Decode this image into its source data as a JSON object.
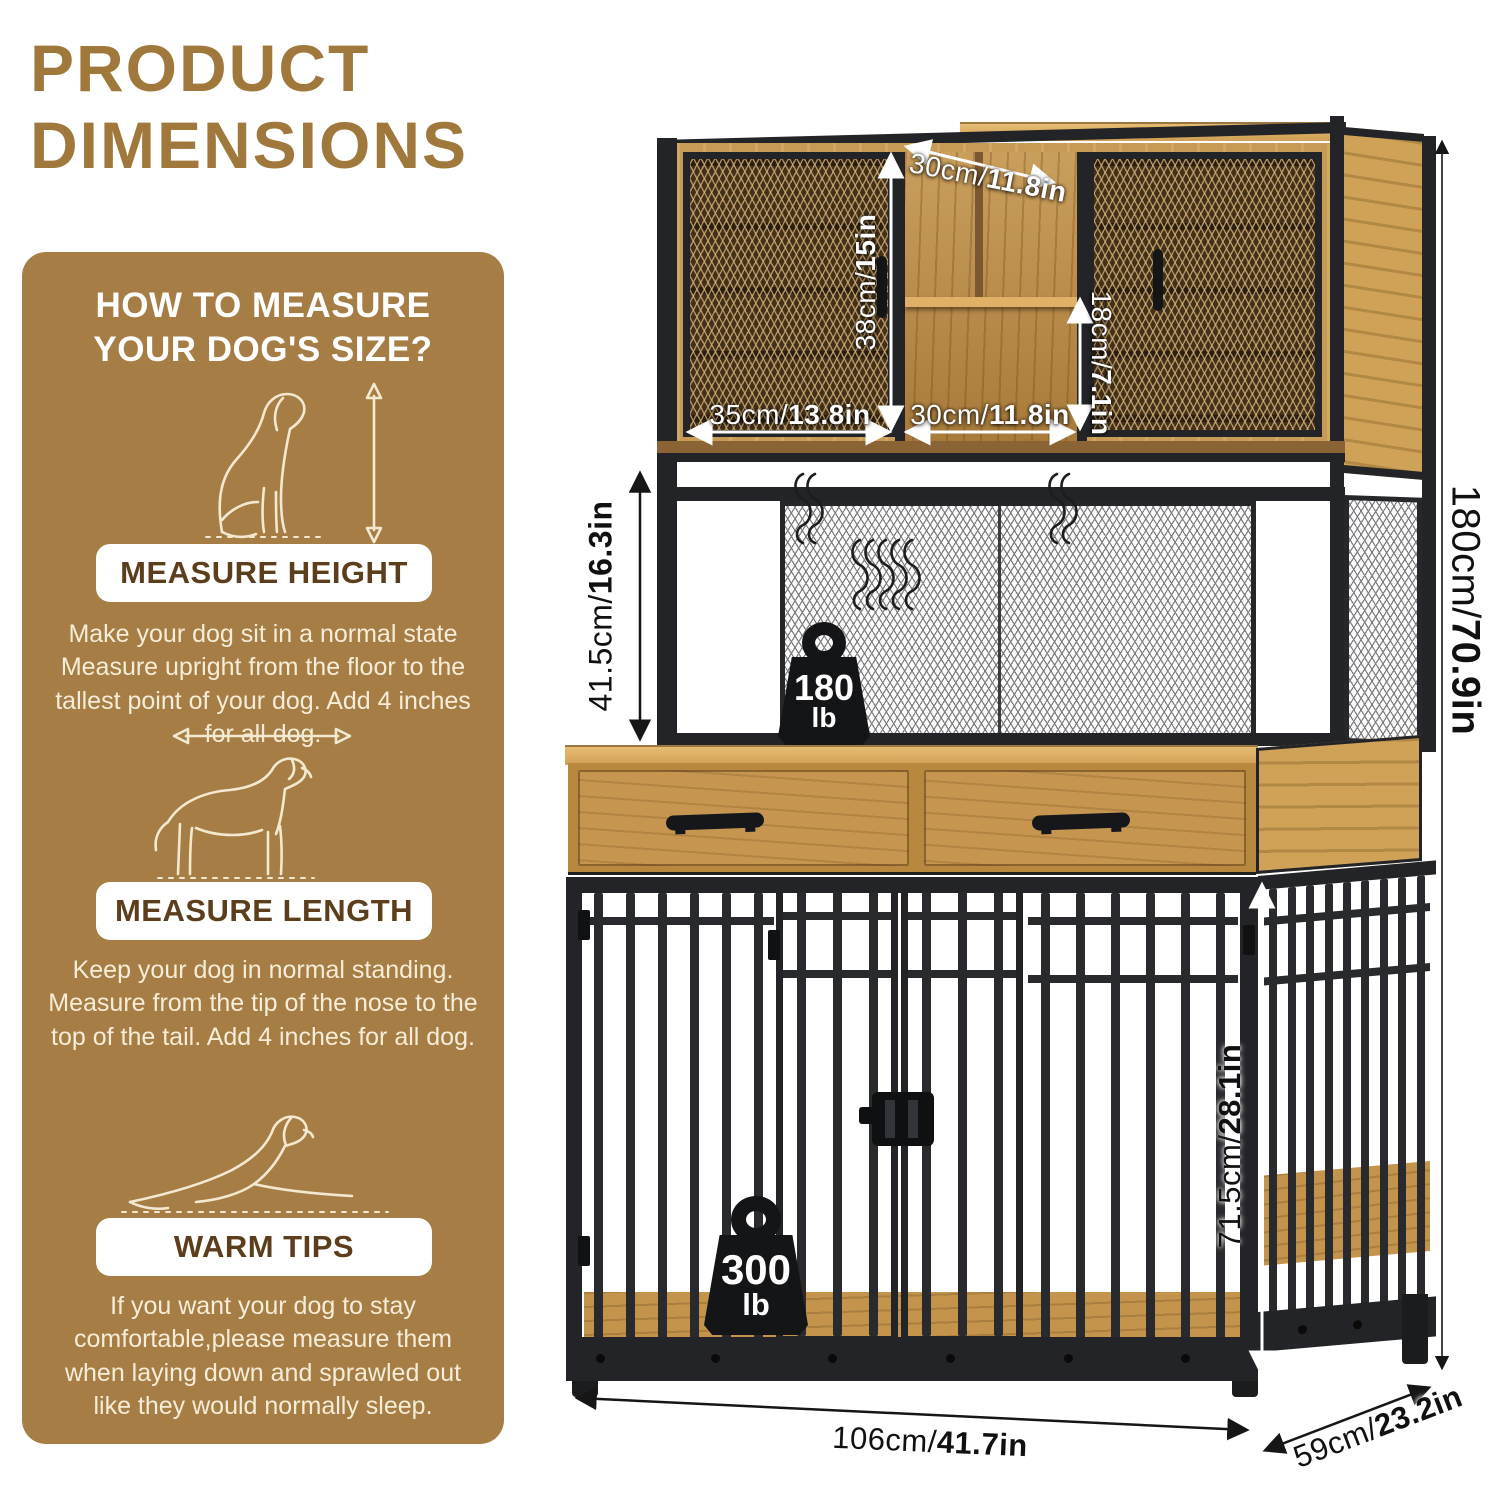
{
  "title": {
    "line1": "PRODUCT",
    "line2": "DIMENSIONS"
  },
  "sidebar": {
    "heading": "HOW TO MEASURE YOUR DOG'S SIZE?",
    "sections": [
      {
        "banner": "MEASURE HEIGHT",
        "text": "Make your dog sit in a normal state Measure upright from the floor to the tallest point of your dog. Add 4 inches for all dog."
      },
      {
        "banner": "MEASURE LENGTH",
        "text": "Keep your dog in normal standing. Measure from the tip of the nose to the top of the tail. Add 4 inches for all dog."
      },
      {
        "banner": "WARM TIPS",
        "text": "If you want your dog to stay comfortable,please measure them when laying down and sprawled out like they would normally sleep."
      }
    ]
  },
  "diagram": {
    "dimensions": {
      "top_depth": {
        "value": "30cm/",
        "bold": "11.8in"
      },
      "hutch_height": {
        "value": "38cm/",
        "bold": "15in"
      },
      "shelf_height": {
        "value": "18cm/",
        "bold": "7.1in"
      },
      "left_door_width": {
        "value": "35cm/",
        "bold": "13.8in"
      },
      "middle_width": {
        "value": "30cm/",
        "bold": "11.8in"
      },
      "middle_section_height": {
        "value": "41.5cm/",
        "bold": "16.3in"
      },
      "overall_height": {
        "value": "180cm/",
        "bold": "70.9in"
      },
      "crate_height": {
        "value": "71.5cm/",
        "bold": "28.1in"
      },
      "overall_width": {
        "value": "106cm/",
        "bold": "41.7in"
      },
      "overall_depth": {
        "value": "59cm/",
        "bold": "23.2in"
      }
    },
    "capacities": {
      "hutch": {
        "value": "180",
        "unit": "lb"
      },
      "crate": {
        "value": "300",
        "unit": "lb"
      }
    }
  },
  "colors": {
    "accent": "#a1783c",
    "panel": "#a67d45",
    "wood": "#c79a55",
    "metal": "#232427"
  }
}
